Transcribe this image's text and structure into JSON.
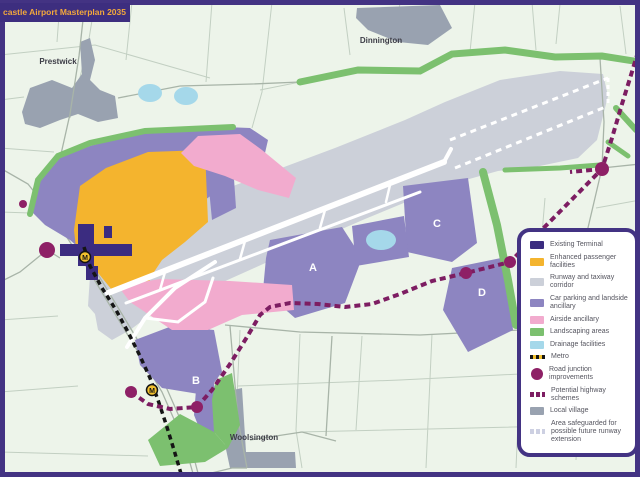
{
  "title": {
    "text": "castle Airport Masterplan 2035"
  },
  "villages": [
    {
      "name": "Prestwick"
    },
    {
      "name": "Dinnington"
    },
    {
      "name": "Woolsington"
    }
  ],
  "zones": [
    {
      "label": "A"
    },
    {
      "label": "B"
    },
    {
      "label": "C"
    },
    {
      "label": "D"
    }
  ],
  "metro": {
    "station_label": "M"
  },
  "legend": {
    "items": [
      {
        "label": "Existing Terminal",
        "type": "swatch",
        "color": "#3b2c80"
      },
      {
        "label": "Enhanced passenger facilities",
        "type": "swatch",
        "color": "#f4b42e"
      },
      {
        "label": "Runway and taxiway corridor",
        "type": "swatch",
        "color": "#ccd0d9"
      },
      {
        "label": "Car parking and landside ancillary",
        "type": "swatch",
        "color": "#8d85c1"
      },
      {
        "label": "Airside ancillary",
        "type": "swatch",
        "color": "#f2abce"
      },
      {
        "label": "Landscaping areas",
        "type": "swatch",
        "color": "#7cc06f"
      },
      {
        "label": "Drainage facilities",
        "type": "swatch",
        "color": "#a5d8ea"
      },
      {
        "label": "Metro",
        "type": "dashed-line",
        "color": "#151515"
      },
      {
        "label": "Road junction improvements",
        "type": "circle",
        "color": "#8e2066"
      },
      {
        "label": "Potential highway schemes",
        "type": "dashed-line",
        "color": "#7d1d62"
      },
      {
        "label": "Local village",
        "type": "swatch",
        "color": "#99a2b0"
      },
      {
        "label": "Area safeguarded for possible future runway extension",
        "type": "dashed-line",
        "color": "#cdd0e2"
      }
    ]
  },
  "colors": {
    "frame": "#433383",
    "banner_bg": "#3d2e7f",
    "banner_text": "#f2a83c",
    "map_background": "#edf4ea",
    "metro_station": "#f2c12e",
    "junction": "#8e2066",
    "highway_dashes": "#7d1d62"
  }
}
